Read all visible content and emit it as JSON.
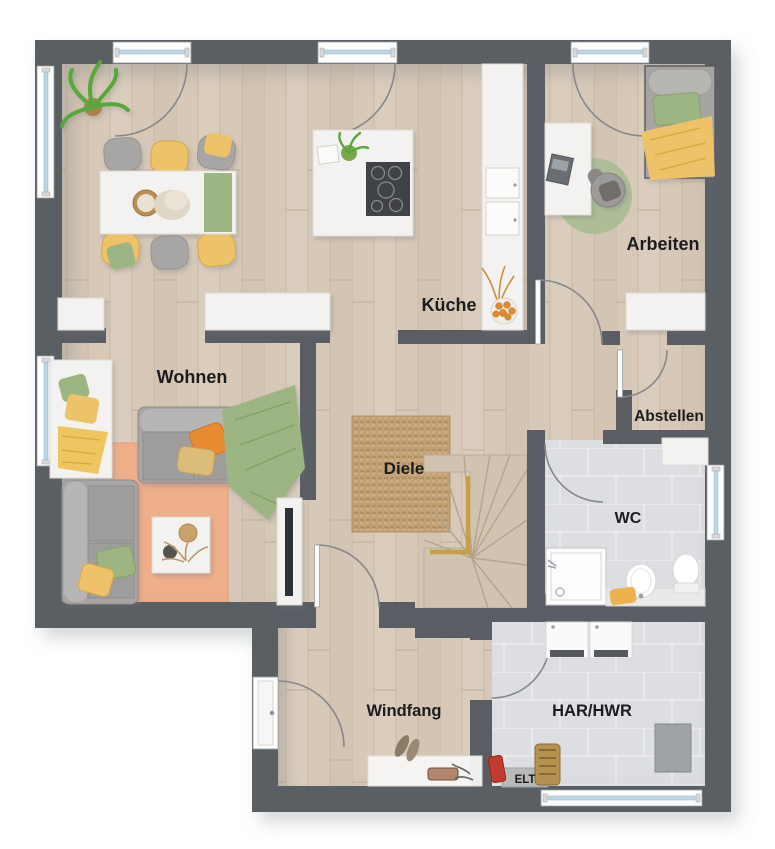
{
  "plan": {
    "type": "residential-floor-plan",
    "floor_labels": {
      "wohnen": "Wohnen",
      "kueche": "Küche",
      "arbeiten": "Arbeiten",
      "abstellen": "Abstellen",
      "diele": "Diele",
      "wc": "WC",
      "windfang": "Windfang",
      "har_hwr": "HAR/HWR",
      "elt": "ELT"
    }
  },
  "colors": {
    "wall": "#5a5e64",
    "floor_wood": "#d7c8b8",
    "floor_tile": "#dddee1",
    "rug_jute": "#c2a178",
    "rug_orange": "#efae8a",
    "rug_green": "#abbe95",
    "accent_yellow": "#eec267",
    "accent_green": "#9db483",
    "accent_orange": "#e98a31",
    "window_glass": "#bcd6e4",
    "label_text": "#1b1c1e"
  },
  "icons": {
    "doors": [
      "entrance-door",
      "kitchen-terrace-door",
      "dining-terrace-door",
      "arbeiten-terrace-door",
      "arbeiten-room-door",
      "abstellen-door",
      "wc-door",
      "windfang-diele-door",
      "har-door"
    ],
    "windows": [
      "left-window-top",
      "left-window-seat",
      "wc-window",
      "har-window"
    ]
  }
}
